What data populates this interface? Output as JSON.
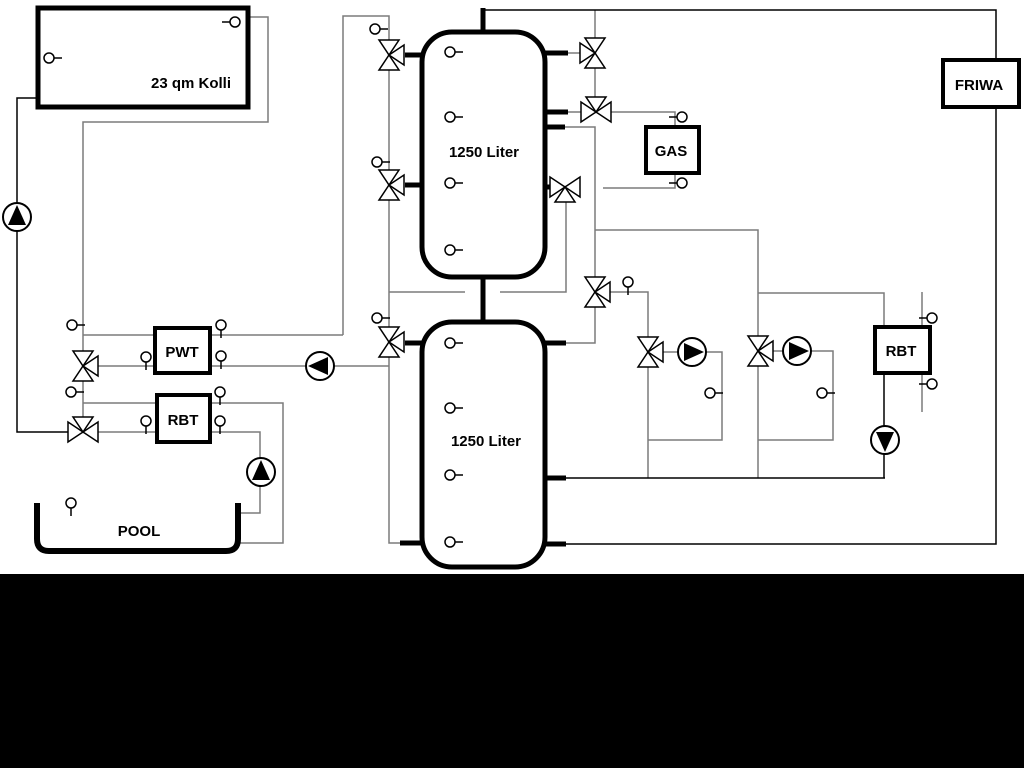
{
  "diagram": {
    "labels": {
      "collector": "23 qm Kolli",
      "tank1": "1250 Liter",
      "tank2": "1250 Liter",
      "gas": "GAS",
      "friwa": "FRIWA",
      "pwt": "PWT",
      "rbt_left": "RBT",
      "rbt_right": "RBT",
      "pool": "POOL"
    },
    "colors": {
      "background": "#ffffff",
      "pipe_gray": "#7b7b7b",
      "pipe_black": "#000000",
      "letterbox_band": "#000000"
    }
  }
}
